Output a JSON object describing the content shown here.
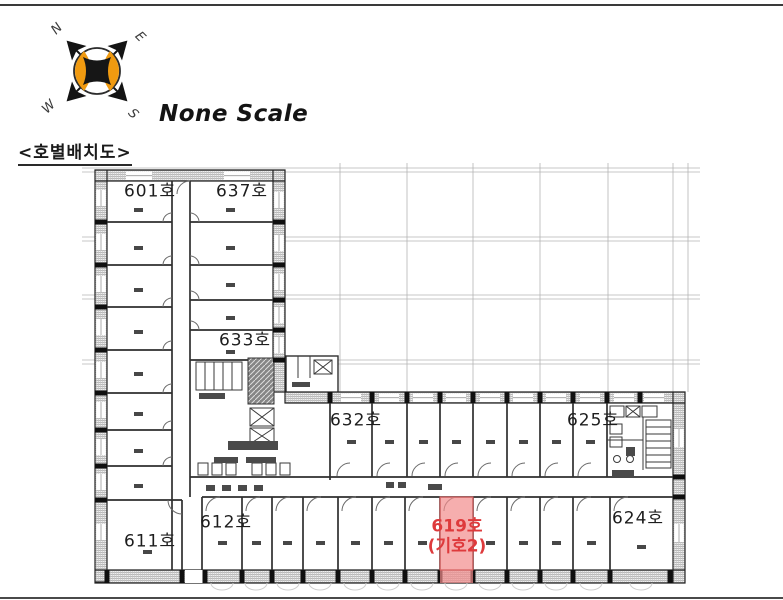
{
  "header": {
    "plan_title": "<호별배치도>",
    "scale_label": "None Scale"
  },
  "compass": {
    "north": "N",
    "east": "E",
    "south": "S",
    "west": "W",
    "accent_color": "#F09A10"
  },
  "floor_plan": {
    "rooms": [
      {
        "label": "601호"
      },
      {
        "label": "637호"
      },
      {
        "label": "633호"
      },
      {
        "label": "632호"
      },
      {
        "label": "625호"
      },
      {
        "label": "611호"
      },
      {
        "label": "612호"
      },
      {
        "label": "624호"
      }
    ],
    "highlighted_room": {
      "label": "619호",
      "marker": "(기호2)",
      "highlight_color": "#F28B8B",
      "text_color": "#DE3A3C"
    }
  }
}
